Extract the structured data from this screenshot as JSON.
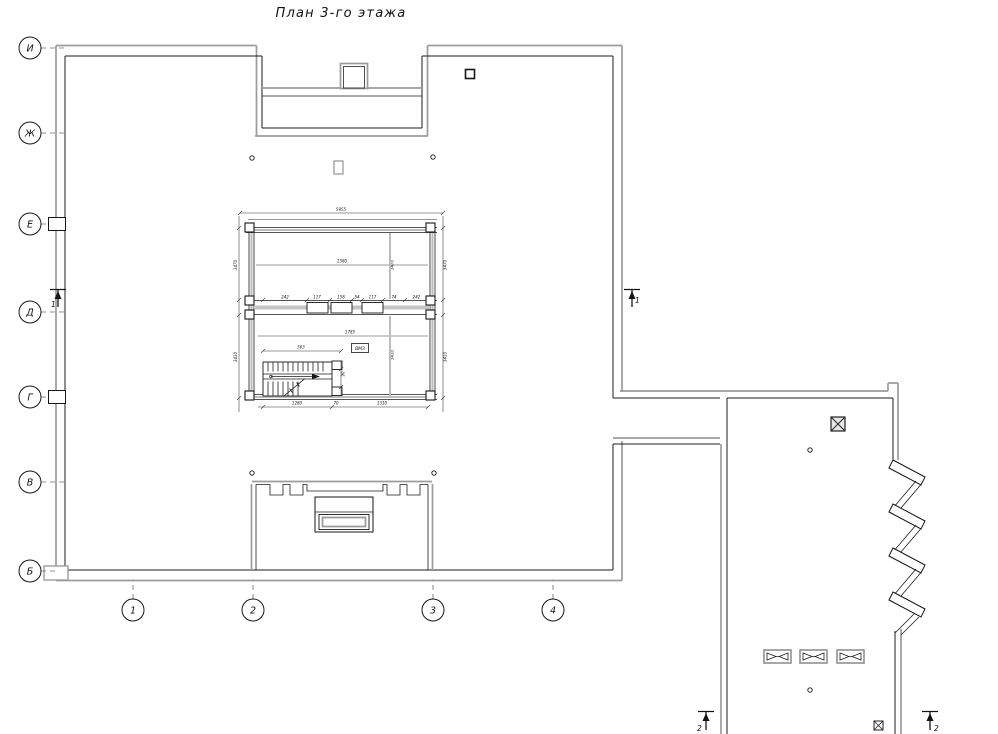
{
  "title": "План 3-го этажа",
  "axes": {
    "rows": [
      "И",
      "Ж",
      "Е",
      "Д",
      "Г",
      "В",
      "Б"
    ],
    "cols": [
      "1",
      "2",
      "3",
      "4"
    ]
  },
  "section_markers": {
    "section1": "1",
    "section2": "2"
  },
  "core_label": "ВМЗ",
  "dims": {
    "overall": "5955",
    "upper_room": "1580",
    "lower_room": "1785",
    "stair": "563",
    "openings": [
      "242",
      "117",
      "158",
      "54",
      "117",
      "74",
      "242"
    ],
    "bottom": [
      "1280",
      "70",
      "1310"
    ],
    "left": [
      "3470",
      "3410"
    ],
    "right": [
      "3470",
      "3410"
    ],
    "inner": [
      "3470",
      "3410"
    ],
    "newel": "90"
  },
  "colors": {
    "line": "#1c1c1c",
    "wall_gray": "#9c9c9c",
    "background": "#ffffff"
  }
}
